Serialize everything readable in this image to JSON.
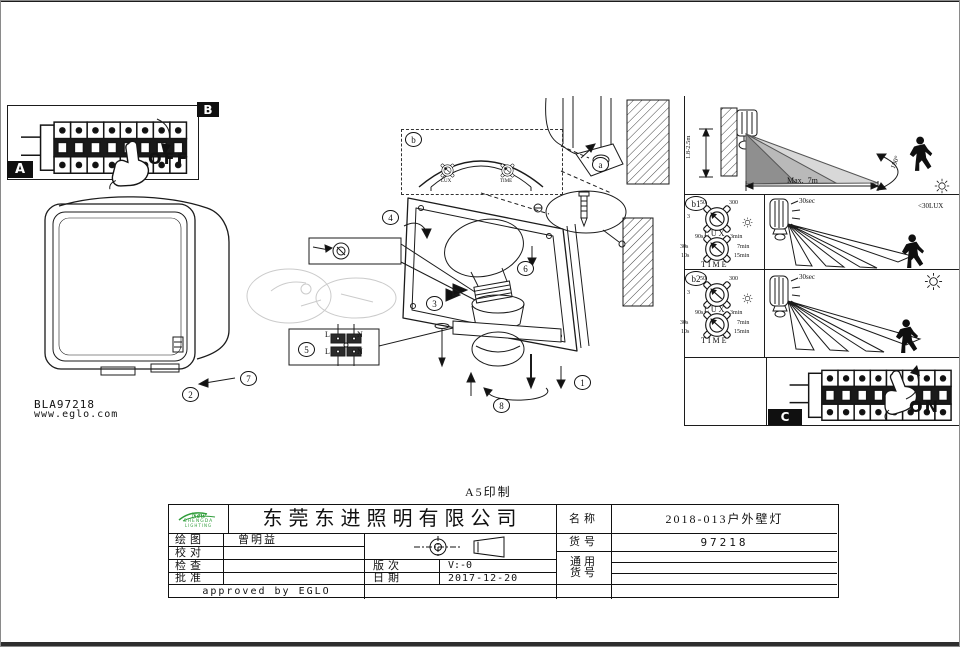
{
  "page": {
    "print_note": "A5印制",
    "ref_code": "BLA97218",
    "website": "www.eglo.com"
  },
  "panels": {
    "a_label": "A",
    "b_label": "B",
    "c_label": "C",
    "off": "OFF",
    "on": "ON",
    "callout_a": "a",
    "callout_b": "b",
    "callout_b1": "b1",
    "callout_b2": "b2"
  },
  "steps": [
    "1",
    "2",
    "3",
    "4",
    "5",
    "6",
    "7",
    "8"
  ],
  "range_diagram": {
    "mount_height": "1.8-2.5m",
    "max_distance": "Max.  7m",
    "angle": "180°"
  },
  "dial": {
    "lux_label": "LUX",
    "time_label": "TIME",
    "lux_ticks": [
      "50",
      "300",
      "3"
    ],
    "time_ticks": [
      "90s",
      "3min",
      "30s",
      "7min",
      "10s",
      "15min"
    ]
  },
  "mode_b1": {
    "duration": "30sec",
    "lux_threshold": "<30LUX"
  },
  "mode_b2": {
    "duration": "30sec"
  },
  "terminals": {
    "live": "L",
    "neutral": "N"
  },
  "title_block": {
    "company": "东莞东进照明有限公司",
    "logo": {
      "brand": "New",
      "line1": "SHENGDA",
      "line2": "LIGHTING"
    },
    "rows": [
      {
        "label": "绘图",
        "value": "曾明益"
      },
      {
        "label": "校对",
        "value": ""
      },
      {
        "label": "检查",
        "value": ""
      },
      {
        "label": "批准",
        "value": ""
      }
    ],
    "revision_label": "版次",
    "revision": "V:-0",
    "date_label": "日期",
    "date": "2017-12-20",
    "approved": "approved by EGLO",
    "name_label": "名称",
    "name": "2018-013户外壁灯",
    "item_label": "货号",
    "item": "97218",
    "common_item_label": [
      "通用",
      "货号"
    ]
  }
}
